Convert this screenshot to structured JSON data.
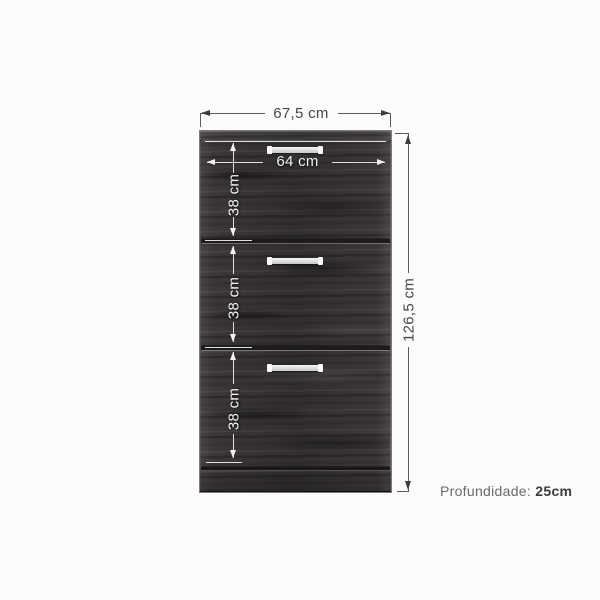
{
  "page": {
    "background": "#fbfbfb"
  },
  "diagram": {
    "dims": {
      "outer_width": "67,5 cm",
      "inner_width": "64 cm",
      "total_height": "126,5 cm"
    },
    "doors": [
      {
        "height_label": "38 cm"
      },
      {
        "height_label": "38 cm"
      },
      {
        "height_label": "38 cm"
      }
    ],
    "depth_note": {
      "prefix": "Profundidade: ",
      "value": "25cm"
    },
    "colors": {
      "outer_dimension_line": "#5a5a5a",
      "outer_dimension_text": "#474747",
      "inner_dimension": "#f2f2f2",
      "wood_base": "#3a3736",
      "divider": "#1e1c1b",
      "handle": "#e8e8e8",
      "depth_text": "#6a6a6a"
    },
    "cabinet": {
      "door_count": 3,
      "handle_count": 3
    }
  }
}
